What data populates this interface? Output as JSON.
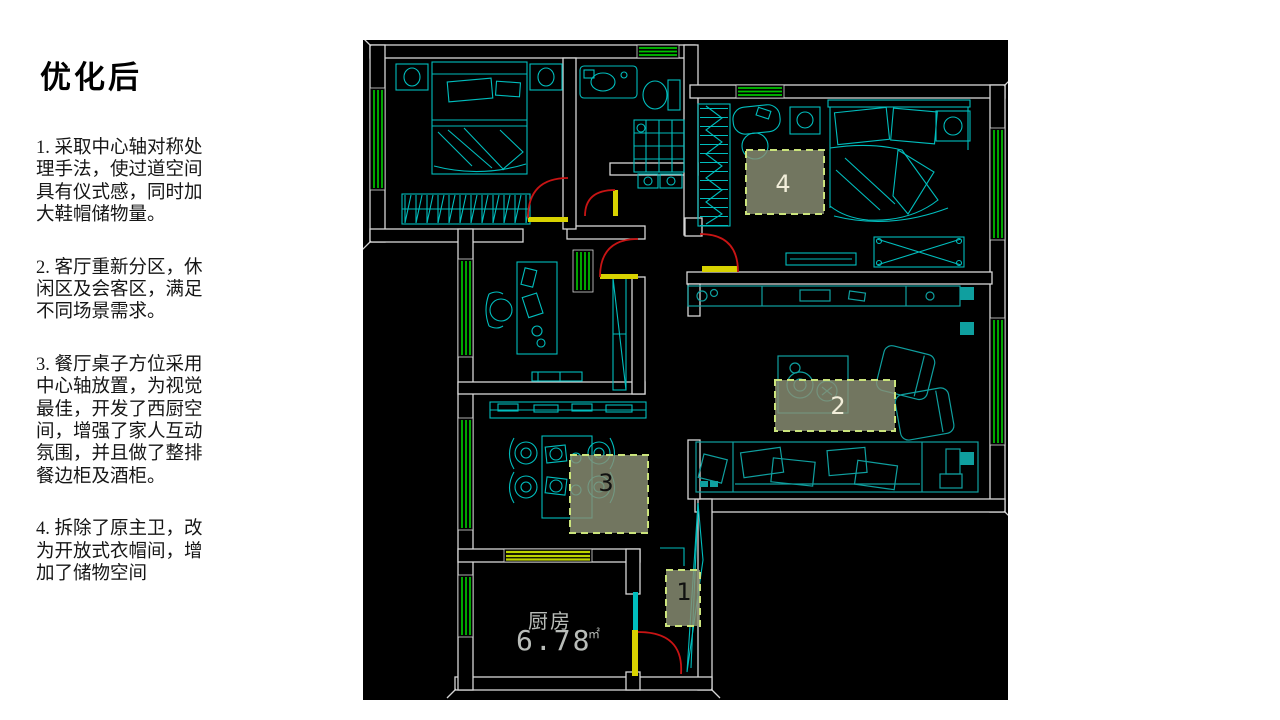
{
  "panel": {
    "title": "优化后",
    "notes": [
      "1. 采取中心轴对称处\n理手法，使过道空间\n具有仪式感，同时加\n大鞋帽储物量。",
      "2. 客厅重新分区，休\n闲区及会客区，满足\n不同场景需求。",
      "3. 餐厅桌子方位采用\n中心轴放置，为视觉\n最佳，开发了西厨空\n间，增强了家人互动\n氛围，并且做了整排\n餐边柜及酒柜。",
      "4. 拆除了原主卫，改\n为开放式衣帽间，增\n加了储物空间"
    ]
  },
  "plan": {
    "kitchen": {
      "name": "厨房",
      "area": "6.78",
      "unit": "㎡"
    },
    "boxes": [
      {
        "label": "1"
      },
      {
        "label": "2"
      },
      {
        "label": "3"
      },
      {
        "label": "4"
      }
    ]
  },
  "colors": {
    "planbg": "#000000",
    "wall": "#d6d6d6",
    "green": "#00c300",
    "chart": "#bcd400",
    "cyan": "#00bdbd",
    "teal": "#0f9f9f",
    "yellow": "#d8d200",
    "red": "#c81414",
    "boxfill": "rgba(139,144,117,0.82)",
    "boxborder": "#cbe47c",
    "boxlight": "#f2eeda",
    "boxdark": "#111111",
    "kittext": "#b9bdb9"
  }
}
